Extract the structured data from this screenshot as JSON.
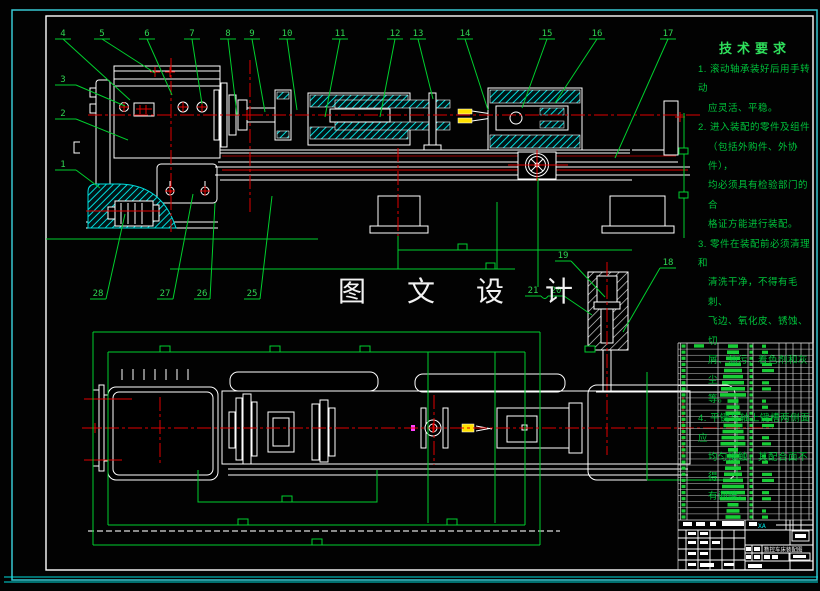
{
  "drawing": {
    "watermark": "图 文 设 计",
    "tech_requirements": {
      "title": "技术要求",
      "lines": [
        "1. 滚动轴承装好后用手转动",
        "应灵活、平稳。",
        "2. 进入装配的零件及组件",
        "（包括外购件、外协件），",
        "均必须具有检验部门的合",
        "格证方能进行装配。",
        "3. 零件在装配前必须清理和",
        "清洗干净，不得有毛刺、",
        "飞边、氧化皮、锈蚀、切",
        "屑、油污、着色剂和灰尘",
        "等。",
        "4. 平键与轴上键槽两侧面应",
        "均匀接触，其配合面不得",
        "有间隙。"
      ]
    },
    "callouts": {
      "top": [
        "4",
        "5",
        "6",
        "7",
        "8",
        "9",
        "10",
        "11",
        "12",
        "13",
        "14",
        "15",
        "16",
        "17"
      ],
      "left": [
        "3",
        "2",
        "1"
      ],
      "bottom": [
        "28",
        "27",
        "26",
        "25"
      ],
      "mid": [
        "21",
        "20",
        "19",
        "18"
      ]
    },
    "title_block": {
      "drawing_name": "数控车床装配图",
      "code": "XA"
    },
    "parts_table": {
      "rows": 29
    },
    "colors": {
      "line_green": "#00cf2e",
      "line_white": "#ffffff",
      "centerline_red": "#e00000",
      "hatch_cyan": "#00dcdc",
      "frame_cyan": "#37c8d2",
      "accent_yellow": "#ffe000"
    }
  }
}
